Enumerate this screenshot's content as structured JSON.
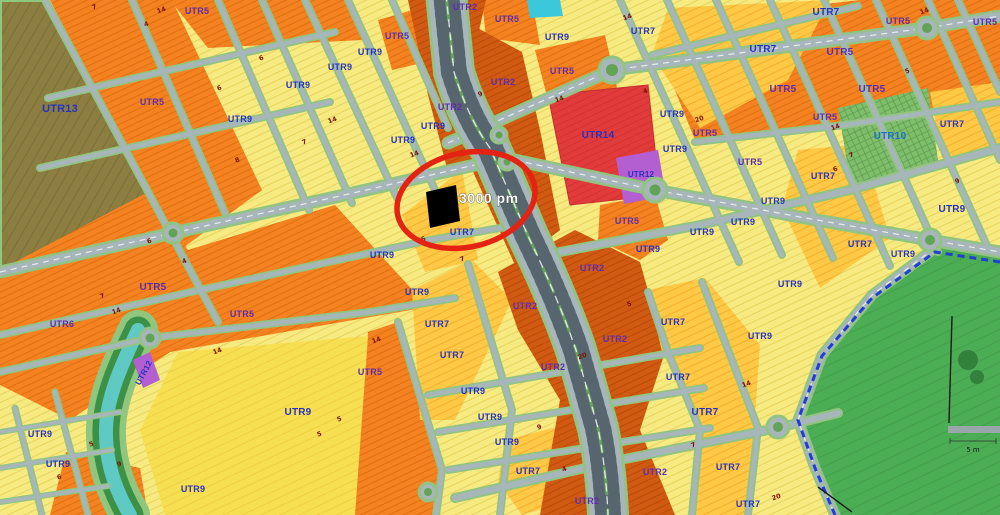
{
  "map": {
    "type": "zoning-map",
    "annotation": {
      "label": "3000 pm",
      "circle_color": "#e42313",
      "parcel_color": "#000000"
    },
    "park": {
      "scale_label": "5 m"
    },
    "palette": {
      "utr2_burnt_orange": "#d15a12",
      "utr5_orange": "#f58220",
      "utr7_amber": "#ffc845",
      "utr9_pale_yellow": "#f6ea80",
      "utr10_green": "#7fbe6b",
      "utr12_purple": "#b35fd1",
      "utr13_olive": "#8b7e40",
      "utr14_red": "#e23b3b",
      "park_green": "#4cae54",
      "river_teal": "#5fc9c4",
      "road_gray": "#a7b6ba",
      "road_edge_green": "#93c383",
      "label_blue": "#2633c0",
      "label_purple": "#5e2dad",
      "park_boundary_blue": "#1f3fd0"
    },
    "zone_labels": [
      {
        "t": "UTR13",
        "x": 60,
        "y": 112,
        "c": "blue",
        "s": 11
      },
      {
        "t": "UTR5",
        "x": 152,
        "y": 105,
        "c": "purple"
      },
      {
        "t": "UTR5",
        "x": 197,
        "y": 14,
        "c": "purple"
      },
      {
        "t": "UTR9",
        "x": 240,
        "y": 122
      },
      {
        "t": "UTR9",
        "x": 298,
        "y": 88
      },
      {
        "t": "UTR9",
        "x": 370,
        "y": 55
      },
      {
        "t": "UTR5",
        "x": 397,
        "y": 39,
        "c": "purple"
      },
      {
        "t": "UTR9",
        "x": 340,
        "y": 70
      },
      {
        "t": "UTR2",
        "x": 465,
        "y": 10,
        "c": "purple"
      },
      {
        "t": "UTR2",
        "x": 450,
        "y": 110,
        "c": "purple"
      },
      {
        "t": "UTR2",
        "x": 503,
        "y": 85,
        "c": "purple"
      },
      {
        "t": "UTR9",
        "x": 433,
        "y": 129
      },
      {
        "t": "UTR9",
        "x": 403,
        "y": 143
      },
      {
        "t": "UTR5",
        "x": 507,
        "y": 22,
        "c": "purple"
      },
      {
        "t": "UTR9",
        "x": 557,
        "y": 40
      },
      {
        "t": "UTR5",
        "x": 562,
        "y": 74,
        "c": "purple"
      },
      {
        "t": "UTR14",
        "x": 598,
        "y": 138,
        "s": 10
      },
      {
        "t": "UTR12",
        "x": 641,
        "y": 177,
        "s": 8
      },
      {
        "t": "UTR7",
        "x": 643,
        "y": 34
      },
      {
        "t": "UTR7",
        "x": 763,
        "y": 52,
        "s": 10
      },
      {
        "t": "UTR7",
        "x": 826,
        "y": 15,
        "s": 10
      },
      {
        "t": "UTR5",
        "x": 898,
        "y": 24,
        "c": "purple"
      },
      {
        "t": "UTR5",
        "x": 985,
        "y": 25,
        "c": "purple"
      },
      {
        "t": "UTR5",
        "x": 840,
        "y": 55,
        "c": "purple",
        "s": 10
      },
      {
        "t": "UTR5",
        "x": 783,
        "y": 92,
        "c": "purple",
        "s": 10
      },
      {
        "t": "UTR5",
        "x": 872,
        "y": 92,
        "c": "purple",
        "s": 10
      },
      {
        "t": "UTR9",
        "x": 672,
        "y": 117
      },
      {
        "t": "UTR5",
        "x": 705,
        "y": 136,
        "c": "purple"
      },
      {
        "t": "UTR10",
        "x": 890,
        "y": 139,
        "c": "teal",
        "s": 10
      },
      {
        "t": "UTR7",
        "x": 952,
        "y": 127
      },
      {
        "t": "UTR5",
        "x": 825,
        "y": 120,
        "c": "purple"
      },
      {
        "t": "UTR9",
        "x": 675,
        "y": 152
      },
      {
        "t": "UTR5",
        "x": 750,
        "y": 165,
        "c": "purple"
      },
      {
        "t": "UTR7",
        "x": 823,
        "y": 179
      },
      {
        "t": "UTR9",
        "x": 952,
        "y": 212,
        "s": 10
      },
      {
        "t": "UTR7",
        "x": 860,
        "y": 247
      },
      {
        "t": "UTR9",
        "x": 903,
        "y": 257
      },
      {
        "t": "UTR9",
        "x": 790,
        "y": 287
      },
      {
        "t": "UTR5",
        "x": 627,
        "y": 224,
        "c": "purple"
      },
      {
        "t": "UTR9",
        "x": 648,
        "y": 252
      },
      {
        "t": "UTR9",
        "x": 702,
        "y": 235
      },
      {
        "t": "UTR9",
        "x": 743,
        "y": 225
      },
      {
        "t": "UTR9",
        "x": 773,
        "y": 204
      },
      {
        "t": "UTR2",
        "x": 592,
        "y": 271,
        "c": "purple"
      },
      {
        "t": "UTR2",
        "x": 615,
        "y": 342,
        "c": "purple"
      },
      {
        "t": "UTR9",
        "x": 760,
        "y": 339
      },
      {
        "t": "UTR7",
        "x": 673,
        "y": 325
      },
      {
        "t": "UTR7",
        "x": 678,
        "y": 380
      },
      {
        "t": "UTR2",
        "x": 525,
        "y": 309,
        "c": "purple"
      },
      {
        "t": "UTR2",
        "x": 553,
        "y": 370,
        "c": "purple"
      },
      {
        "t": "UTR7",
        "x": 437,
        "y": 327
      },
      {
        "t": "UTR7",
        "x": 452,
        "y": 358
      },
      {
        "t": "UTR9",
        "x": 382,
        "y": 258
      },
      {
        "t": "UTR9",
        "x": 417,
        "y": 295
      },
      {
        "t": "UTR7",
        "x": 462,
        "y": 235
      },
      {
        "t": "UTR5",
        "x": 370,
        "y": 375,
        "c": "purple"
      },
      {
        "t": "UTR9",
        "x": 298,
        "y": 415,
        "s": 10
      },
      {
        "t": "UTR9",
        "x": 193,
        "y": 492
      },
      {
        "t": "UTR5",
        "x": 153,
        "y": 290,
        "c": "purple",
        "s": 10
      },
      {
        "t": "UTR5",
        "x": 242,
        "y": 317,
        "c": "purple"
      },
      {
        "t": "UTR6",
        "x": 62,
        "y": 327,
        "c": "purple"
      },
      {
        "t": "UTR9",
        "x": 40,
        "y": 437
      },
      {
        "t": "UTR9",
        "x": 58,
        "y": 467
      },
      {
        "t": "UTR9",
        "x": 473,
        "y": 394
      },
      {
        "t": "UTR9",
        "x": 490,
        "y": 420
      },
      {
        "t": "UTR9",
        "x": 507,
        "y": 445
      },
      {
        "t": "UTR7",
        "x": 528,
        "y": 474
      },
      {
        "t": "UTR2",
        "x": 587,
        "y": 504,
        "c": "purple"
      },
      {
        "t": "UTR2",
        "x": 655,
        "y": 475,
        "c": "purple"
      },
      {
        "t": "UTR7",
        "x": 705,
        "y": 415,
        "s": 10
      },
      {
        "t": "UTR7",
        "x": 728,
        "y": 470
      },
      {
        "t": "UTR7",
        "x": 748,
        "y": 507
      },
      {
        "t": "UTR12",
        "x": 146,
        "y": 374,
        "r": -62,
        "s": 8
      }
    ],
    "road_numbers": [
      {
        "t": "7",
        "x": 95,
        "y": 9
      },
      {
        "t": "14",
        "x": 162,
        "y": 12
      },
      {
        "t": "4",
        "x": 147,
        "y": 26
      },
      {
        "t": "6",
        "x": 262,
        "y": 60
      },
      {
        "t": "6",
        "x": 220,
        "y": 90
      },
      {
        "t": "7",
        "x": 305,
        "y": 144
      },
      {
        "t": "14",
        "x": 333,
        "y": 122
      },
      {
        "t": "8",
        "x": 238,
        "y": 162
      },
      {
        "t": "7",
        "x": 103,
        "y": 298
      },
      {
        "t": "14",
        "x": 117,
        "y": 313
      },
      {
        "t": "6",
        "x": 150,
        "y": 243
      },
      {
        "t": "4",
        "x": 185,
        "y": 263
      },
      {
        "t": "14",
        "x": 415,
        "y": 156
      },
      {
        "t": "9",
        "x": 481,
        "y": 96
      },
      {
        "t": "14",
        "x": 560,
        "y": 101
      },
      {
        "t": "14",
        "x": 628,
        "y": 19
      },
      {
        "t": "4",
        "x": 646,
        "y": 93
      },
      {
        "t": "5",
        "x": 908,
        "y": 73
      },
      {
        "t": "14",
        "x": 925,
        "y": 13
      },
      {
        "t": "20",
        "x": 700,
        "y": 121
      },
      {
        "t": "6",
        "x": 836,
        "y": 171
      },
      {
        "t": "7",
        "x": 852,
        "y": 157
      },
      {
        "t": "14",
        "x": 836,
        "y": 129
      },
      {
        "t": "6",
        "x": 424,
        "y": 241
      },
      {
        "t": "7",
        "x": 463,
        "y": 261
      },
      {
        "t": "20",
        "x": 583,
        "y": 358
      },
      {
        "t": "5",
        "x": 340,
        "y": 421
      },
      {
        "t": "5",
        "x": 320,
        "y": 436
      },
      {
        "t": "14",
        "x": 377,
        "y": 342
      },
      {
        "t": "9",
        "x": 540,
        "y": 429
      },
      {
        "t": "4",
        "x": 565,
        "y": 471
      },
      {
        "t": "7",
        "x": 694,
        "y": 447
      },
      {
        "t": "14",
        "x": 747,
        "y": 386
      },
      {
        "t": "20",
        "x": 777,
        "y": 499
      },
      {
        "t": "5",
        "x": 92,
        "y": 446
      },
      {
        "t": "6",
        "x": 60,
        "y": 479
      },
      {
        "t": "9",
        "x": 120,
        "y": 466
      },
      {
        "t": "9",
        "x": 958,
        "y": 183
      },
      {
        "t": "14",
        "x": 218,
        "y": 353
      },
      {
        "t": "5",
        "x": 630,
        "y": 306
      }
    ]
  }
}
